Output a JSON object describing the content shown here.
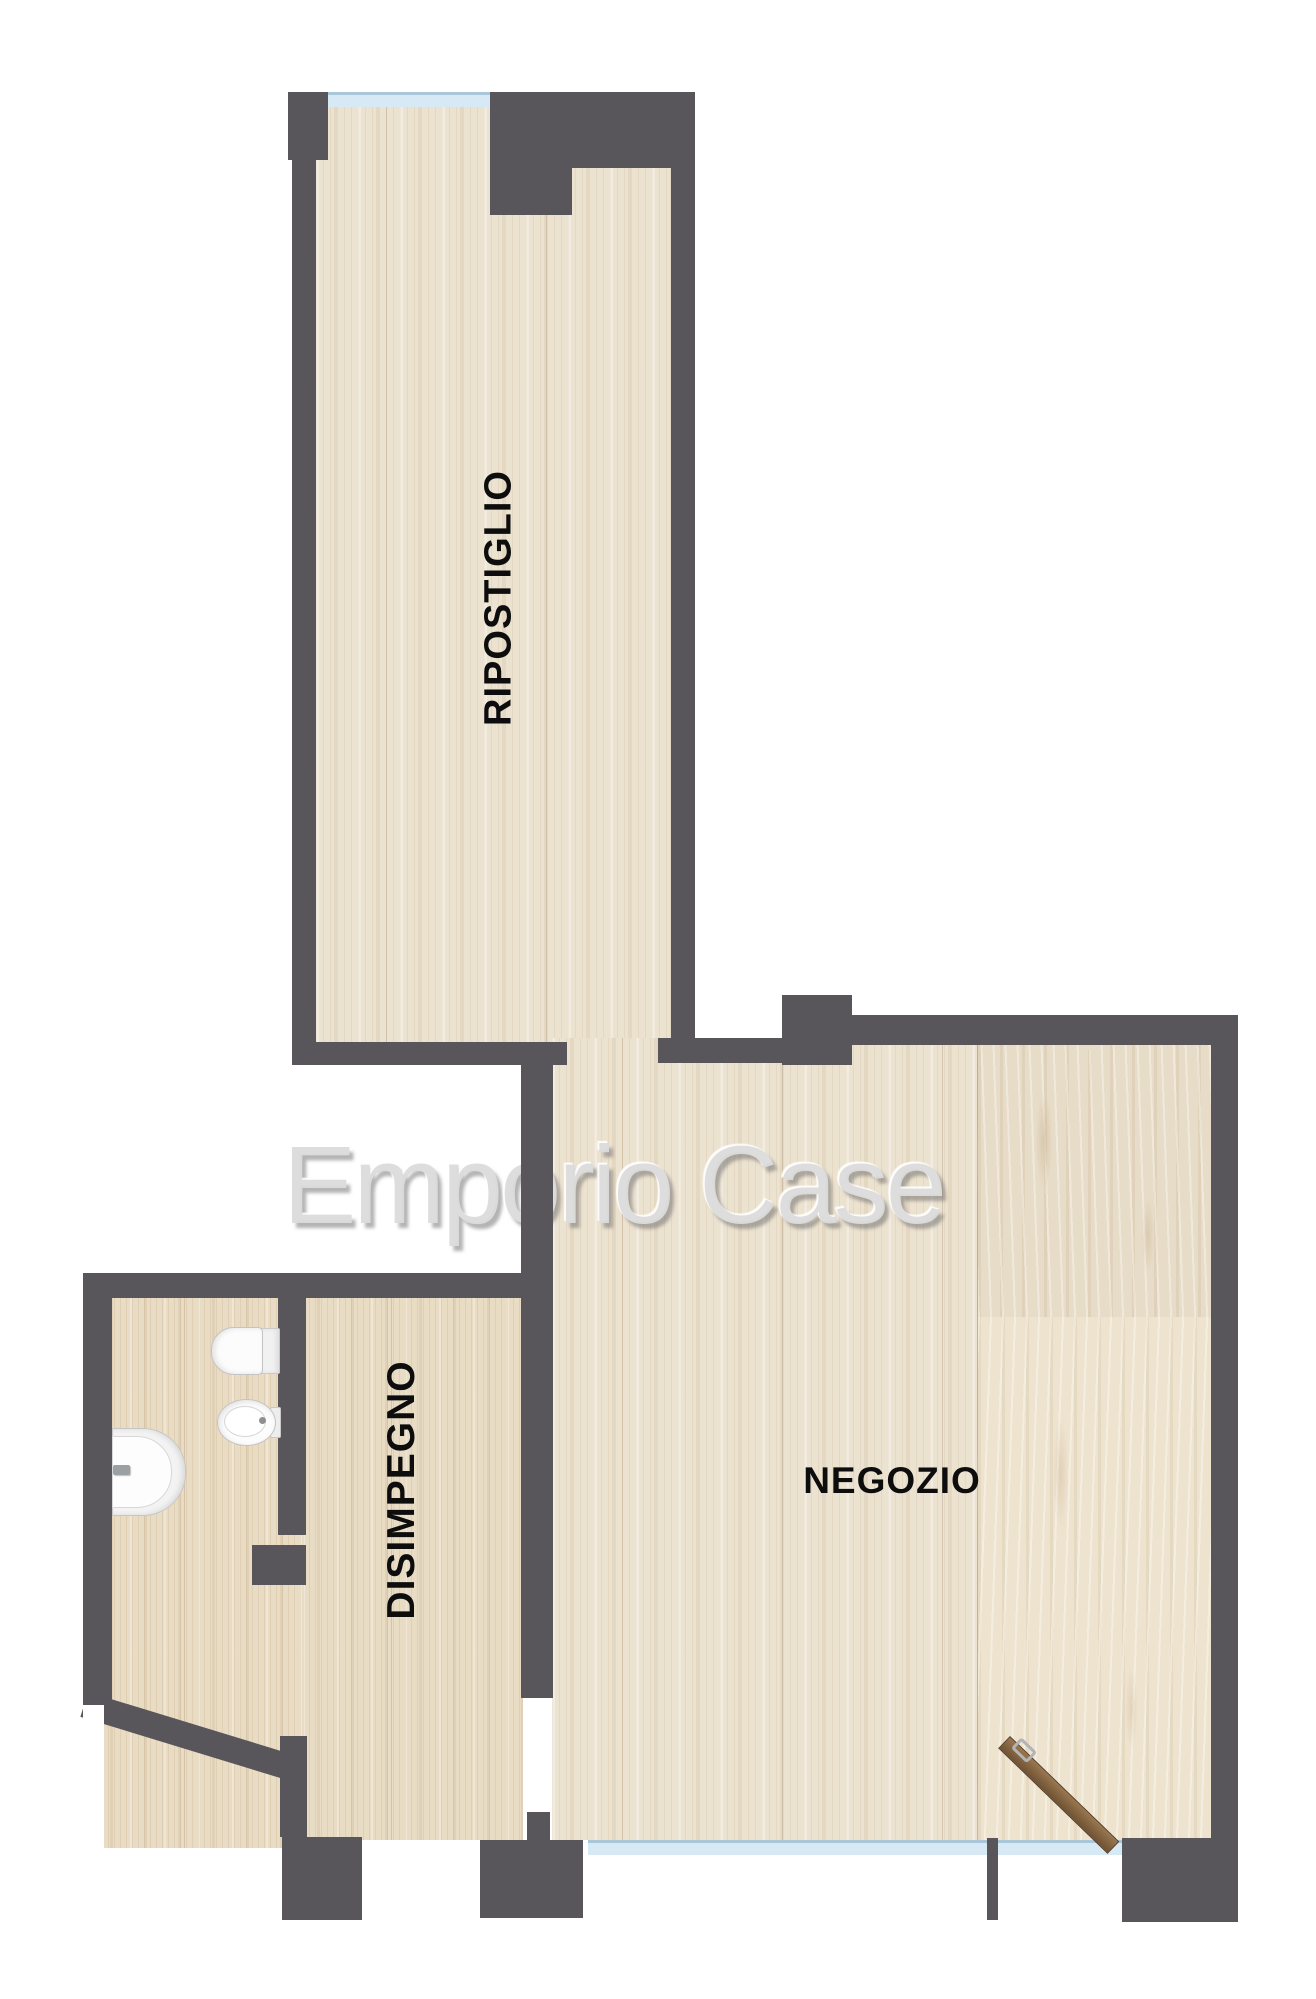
{
  "plan": {
    "watermark": "Emporio Case",
    "rooms": [
      {
        "name": "ripostiglio",
        "label": "RIPOSTIGLIO"
      },
      {
        "name": "disimpegno",
        "label": "DISIMPEGNO"
      },
      {
        "name": "negozio",
        "label": "NEGOZIO"
      }
    ],
    "fixtures": [
      {
        "name": "toilet"
      },
      {
        "name": "bidet"
      },
      {
        "name": "corner-sink"
      },
      {
        "name": "entrance-door-leaf"
      }
    ],
    "windows": [
      {
        "name": "ripostiglio-window"
      },
      {
        "name": "storefront-window-left"
      },
      {
        "name": "storefront-window-entrance"
      }
    ],
    "colors": {
      "wall": "#58565a",
      "floor_light": "#ece2d0",
      "floor_warm": "#e9dcc4",
      "floor_knotty": "#e7dcc8",
      "window_glass": "#d7e9f4",
      "door_wood": "#8a6a47",
      "label_text": "#0d0d0d",
      "watermark_gray": "#dbdbdb",
      "background": "#ffffff"
    }
  }
}
